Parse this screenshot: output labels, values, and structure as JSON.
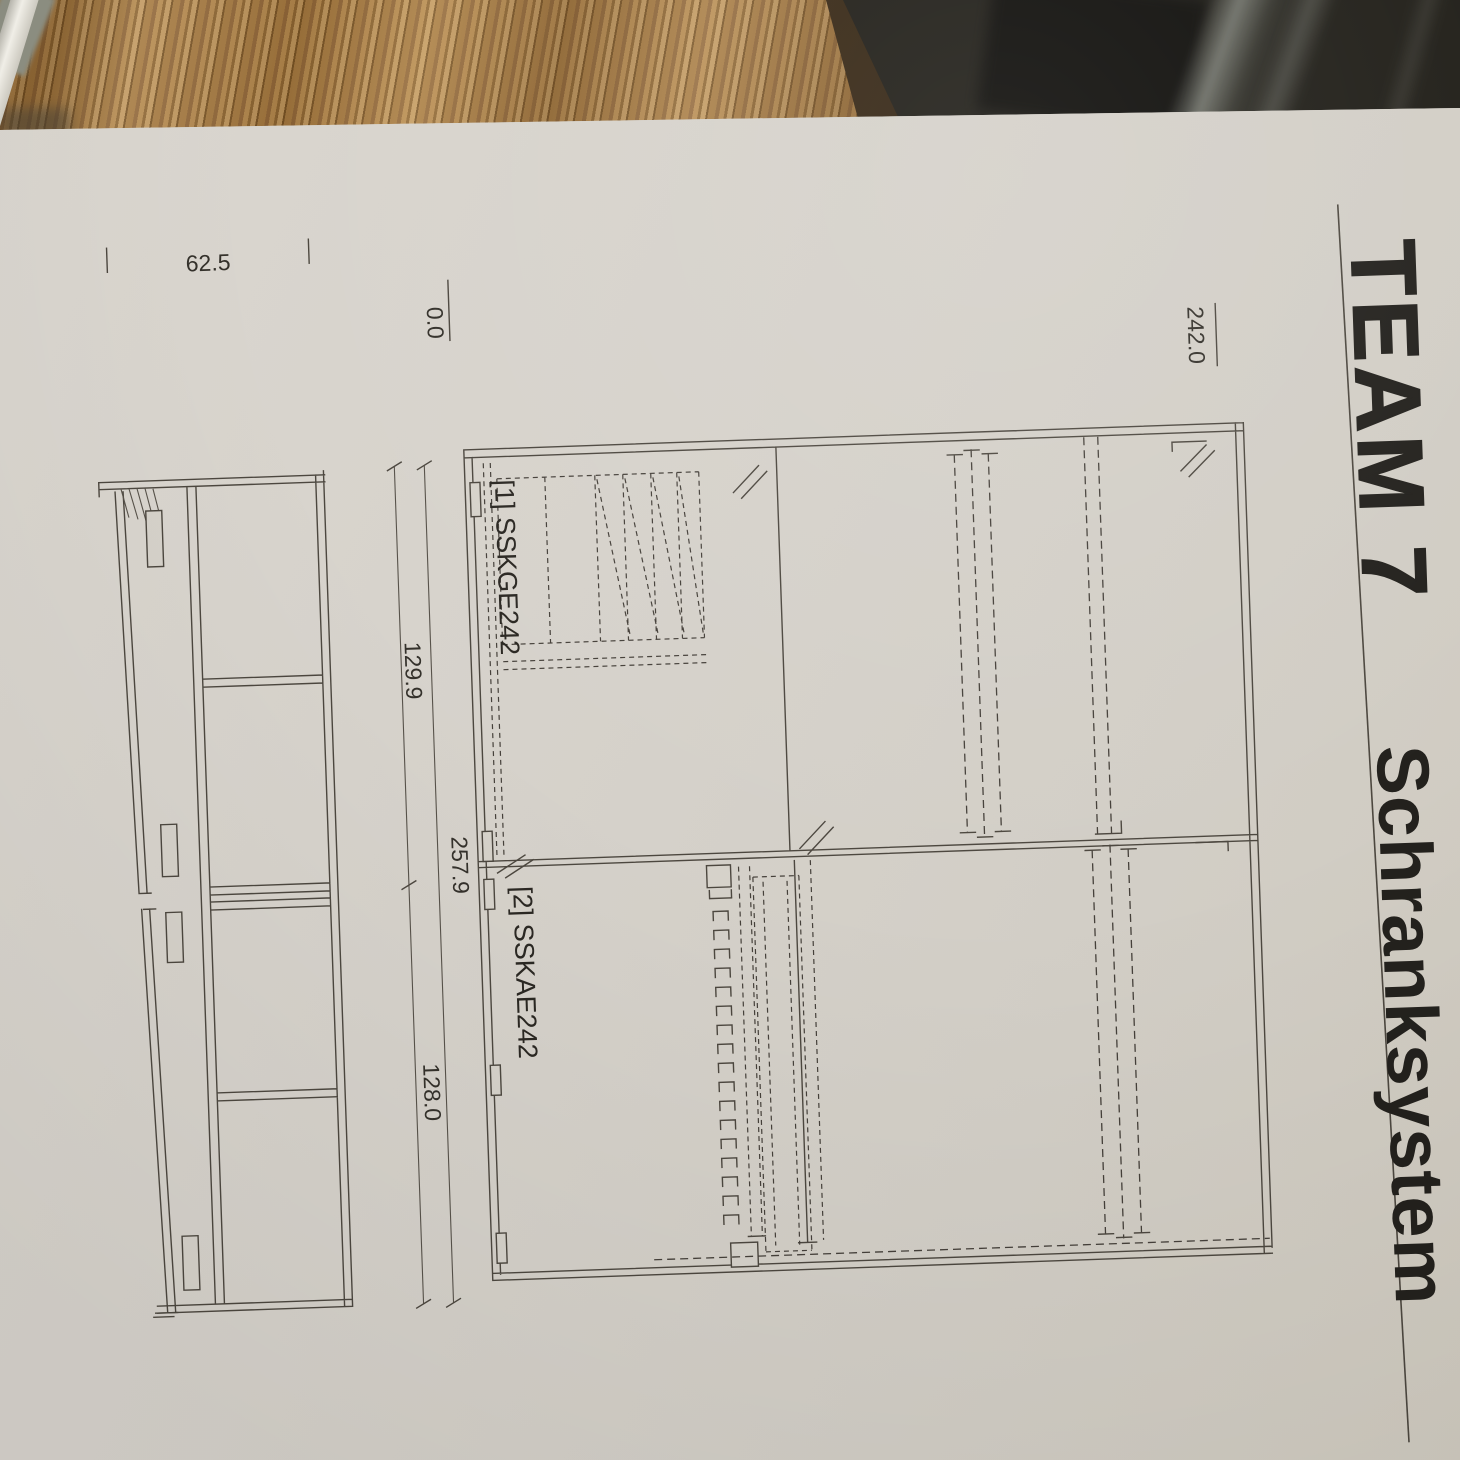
{
  "scene": {
    "background": {
      "wood_table_color": "#a87c45",
      "wood_edge_color": "#3f2e18",
      "dark_surface_color": "#201e18",
      "cable_color": "#f4f2eb",
      "paper_color": "#d6d2ca",
      "line_color": "#4c473f"
    },
    "paper": {
      "header": {
        "brand": "TEAM 7",
        "title": "Schranksystem"
      },
      "drawing": {
        "units": [
          {
            "label": "[1] SSKGE242"
          },
          {
            "label": "[2] SSKAE242"
          }
        ],
        "dimensions": {
          "depth": "62.5",
          "floor_level": "0.0",
          "top_level": "242.0",
          "upper_unit_height": "129.9",
          "lower_unit_height": "128.0",
          "total_height": "257.9"
        }
      }
    }
  }
}
